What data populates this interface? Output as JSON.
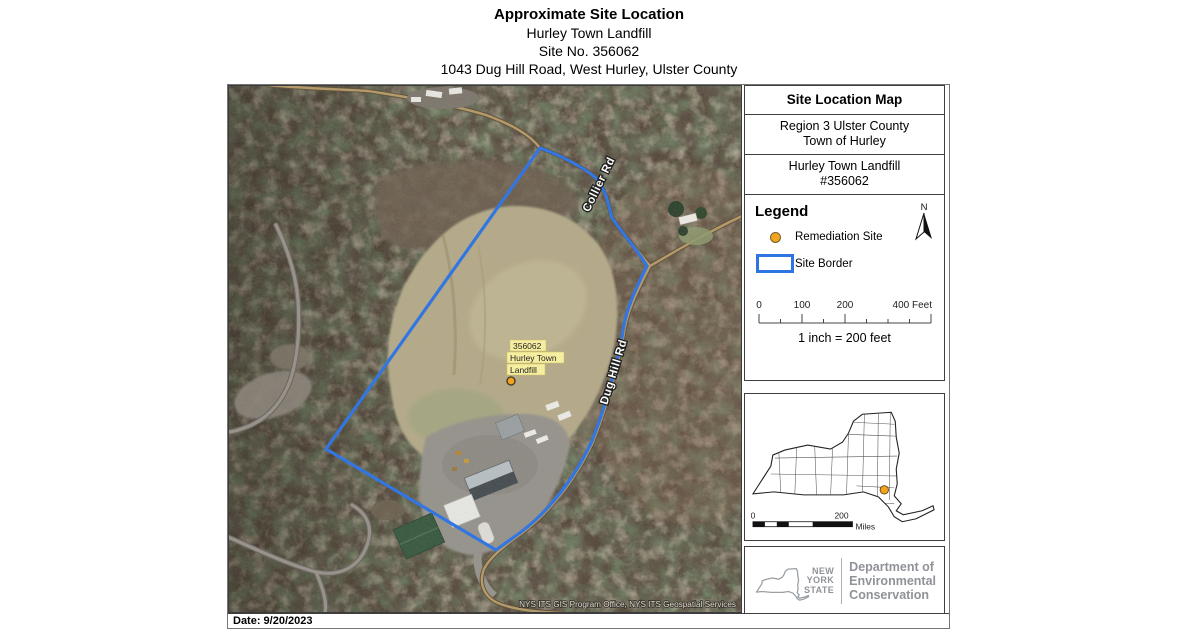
{
  "title": {
    "line1": "Approximate Site Location",
    "line2": "Hurley Town Landfill",
    "line3": "Site No. 356062",
    "line4": "1043 Dug Hill Road, West Hurley, Ulster County"
  },
  "panel": {
    "header": "Site Location Map",
    "region_line1": "Region 3 Ulster County",
    "region_line2": "Town of Hurley",
    "site_line1": "Hurley Town Landfill",
    "site_line2": "#356062",
    "legend": {
      "heading": "Legend",
      "north_label": "N",
      "items": [
        {
          "label": "Remediation Site"
        },
        {
          "label": "Site Border"
        }
      ],
      "feet_ticks": [
        "0",
        "100",
        "200",
        "400 Feet"
      ],
      "scale_text": "1 inch = 200 feet"
    },
    "statemap": {
      "scale_zero": "0",
      "scale_end": "200",
      "scale_unit": "Miles"
    },
    "logo": {
      "state_line1": "NEW",
      "state_line2": "YORK",
      "state_line3": "STATE",
      "dept_line1": "Department of",
      "dept_line2": "Environmental",
      "dept_line3": "Conservation"
    }
  },
  "map": {
    "site_label": {
      "line1": "356062",
      "line2": "Hurley Town",
      "line3": "Landfill"
    },
    "roads": {
      "collier": "Collier Rd",
      "dughill": "Dug Hill Rd"
    },
    "watermark": "NYS ITS GIS Program Office, NYS ITS Geospatial Services"
  },
  "footer": {
    "date": "Date: 9/20/2023"
  },
  "colors": {
    "site_border": "#2e74e3",
    "remediation_site": "#f2a41f",
    "dec_gray": "#8f9398"
  }
}
